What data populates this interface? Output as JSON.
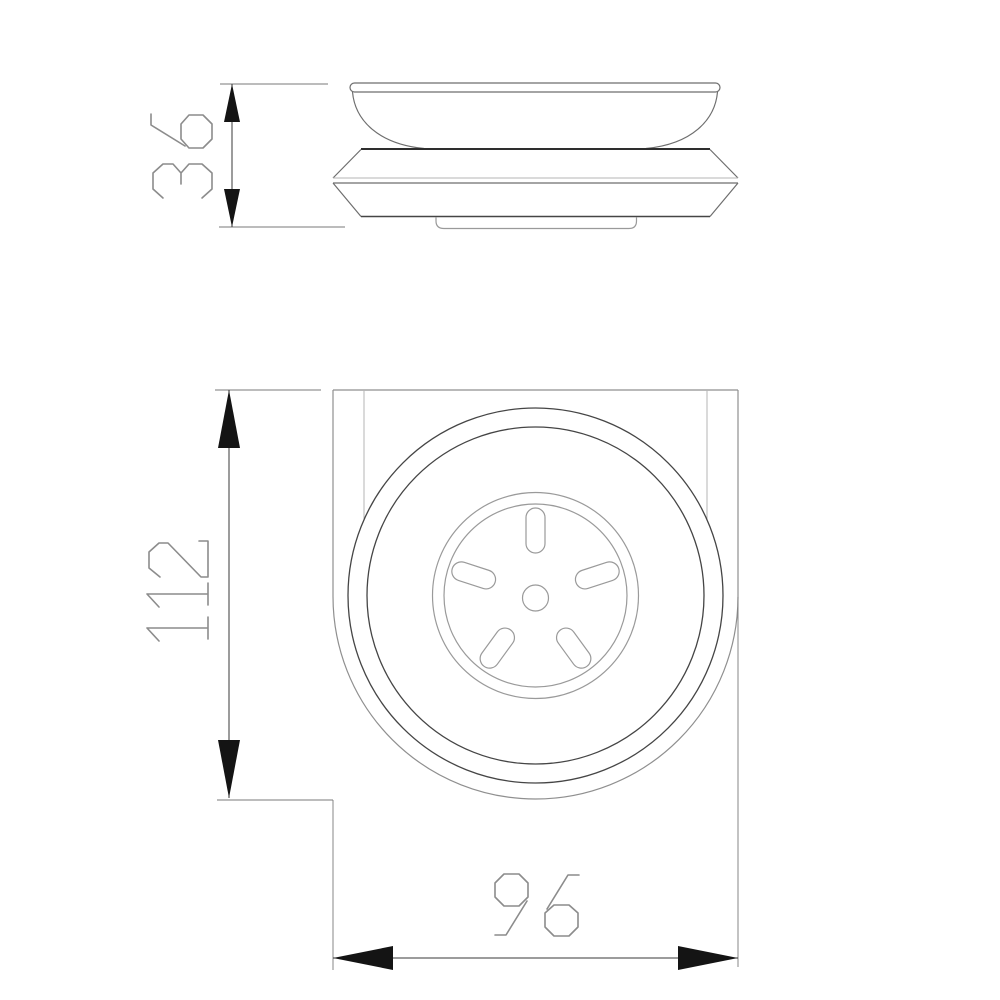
{
  "drawing": {
    "background": "#ffffff",
    "dimensions": {
      "side_height_value": "36",
      "front_height_value": "112",
      "front_width_value": "96"
    },
    "colors": {
      "object_dark": "#2e2e2e",
      "object_ring": "#454545",
      "object_medium": "#6e6e6e",
      "plate_outline": "#8f8f8f",
      "object_light": "#9a9a9a",
      "inner_edge_light": "#b5b5b5",
      "dimension_line": "#3a3a3a",
      "extension_line": "#7a7a7a",
      "arrowhead": "#141414",
      "dimension_text": "#8c8c8c"
    }
  }
}
